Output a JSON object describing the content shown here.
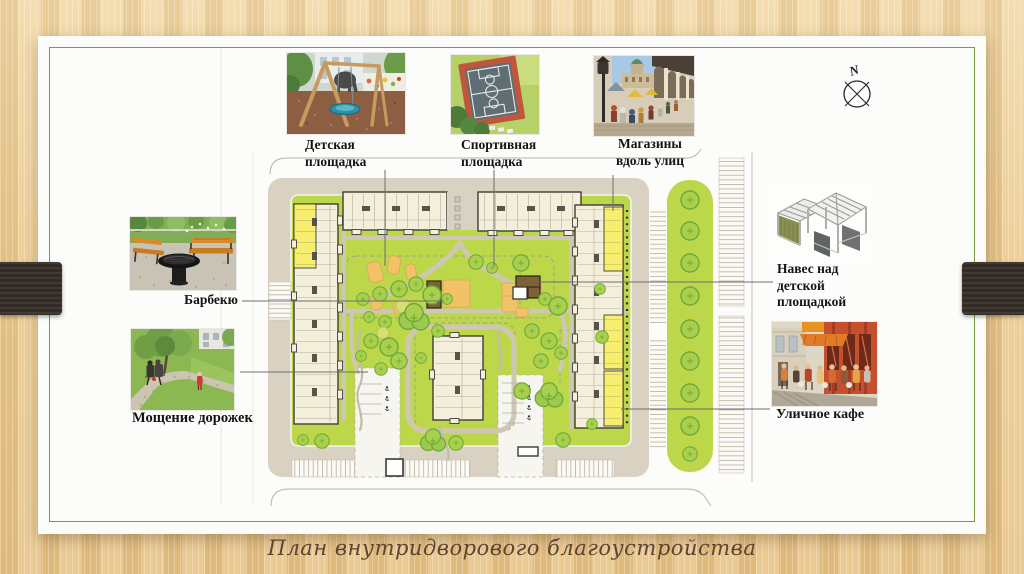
{
  "caption": "План внутридворового благоустройства",
  "compass": {
    "label": "N"
  },
  "callouts": {
    "playground": {
      "lines": [
        "Детская",
        "площадка"
      ],
      "photo": "playground-photo"
    },
    "sport": {
      "lines": [
        "Спортивная",
        "площадка"
      ],
      "photo": "sport-court-photo"
    },
    "shops": {
      "lines": [
        "Магазины",
        "вдоль улиц"
      ],
      "photo": "street-arcade-photo"
    },
    "bbq": {
      "lines": [
        "Барбекю"
      ],
      "photo": "barbecue-photo"
    },
    "paving": {
      "lines": [
        "Мощение дорожек"
      ],
      "photo": "path-paving-photo"
    },
    "canopy": {
      "lines": [
        "Навес над",
        "детской",
        "площадкой"
      ],
      "photo": "canopy-structure-drawing"
    },
    "cafe": {
      "lines": [
        "Уличное кафе"
      ],
      "photo": "street-cafe-photo"
    }
  },
  "colors": {
    "wood_background": "#ecca90",
    "slide_paper": "#fcfcfa",
    "slide_border": "#7d9c3e",
    "grass": "#bdd74b",
    "road": "#d9d1c1",
    "building": "#f4efdb",
    "building_outline": "#3e3e38",
    "shops_highlight": "#f8ee6d",
    "play_area_orange": "#f2c268",
    "canopy_brown": "#8f6f3d",
    "tree_fill": "#a8d04d",
    "tree_outline": "#6fa83a",
    "caption_text": "#5e4431",
    "side_tabs": "#38302a"
  }
}
